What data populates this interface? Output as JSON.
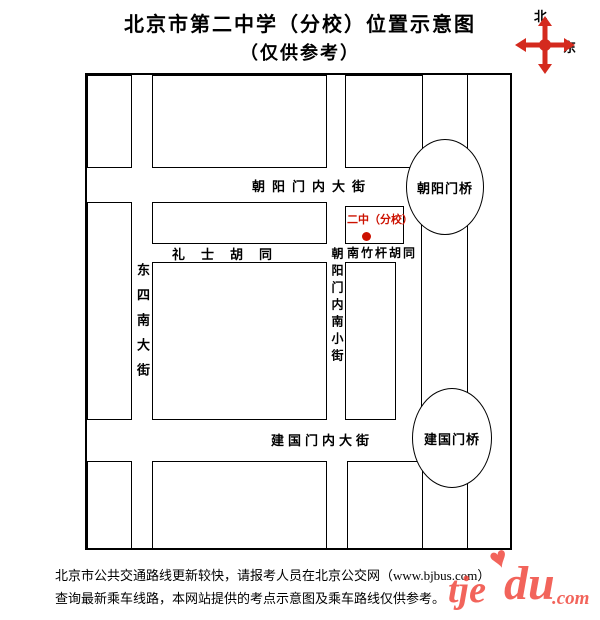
{
  "title": {
    "line1": "北京市第二中学（分校）位置示意图",
    "line2": "（仅供参考）"
  },
  "compass": {
    "north": "北",
    "east": "东",
    "color": "#d42a1e"
  },
  "map": {
    "streets": {
      "chaoyangmennei_dajie": "朝阳门内大街",
      "lishi_hutong": "礼士胡同",
      "nanzhugan_hutong": "南竹杆胡同",
      "jianguomennei_dajie": "建国门内大街",
      "dongsi_nan_dajie": "东四南大街",
      "chaoyangmennei_nanxiaojie": "朝阳门内南小街"
    },
    "bridges": {
      "chaoyangmen": "朝阳门桥",
      "jianguomen": "建国门桥"
    },
    "marker": {
      "label": "二中（分校）",
      "color": "#cc1100"
    }
  },
  "footer": {
    "line1": "北京市公共交通路线更新较快，请报考人员在北京公交网（www.bjbus.com）",
    "line2": "查询最新乘车线路，本网站提供的考点示意图及乘车路线仅供参考。"
  },
  "watermark": {
    "part1": "tje",
    "part2": "du",
    "part3": ".com",
    "heart": "♥",
    "color": "#f04338"
  }
}
